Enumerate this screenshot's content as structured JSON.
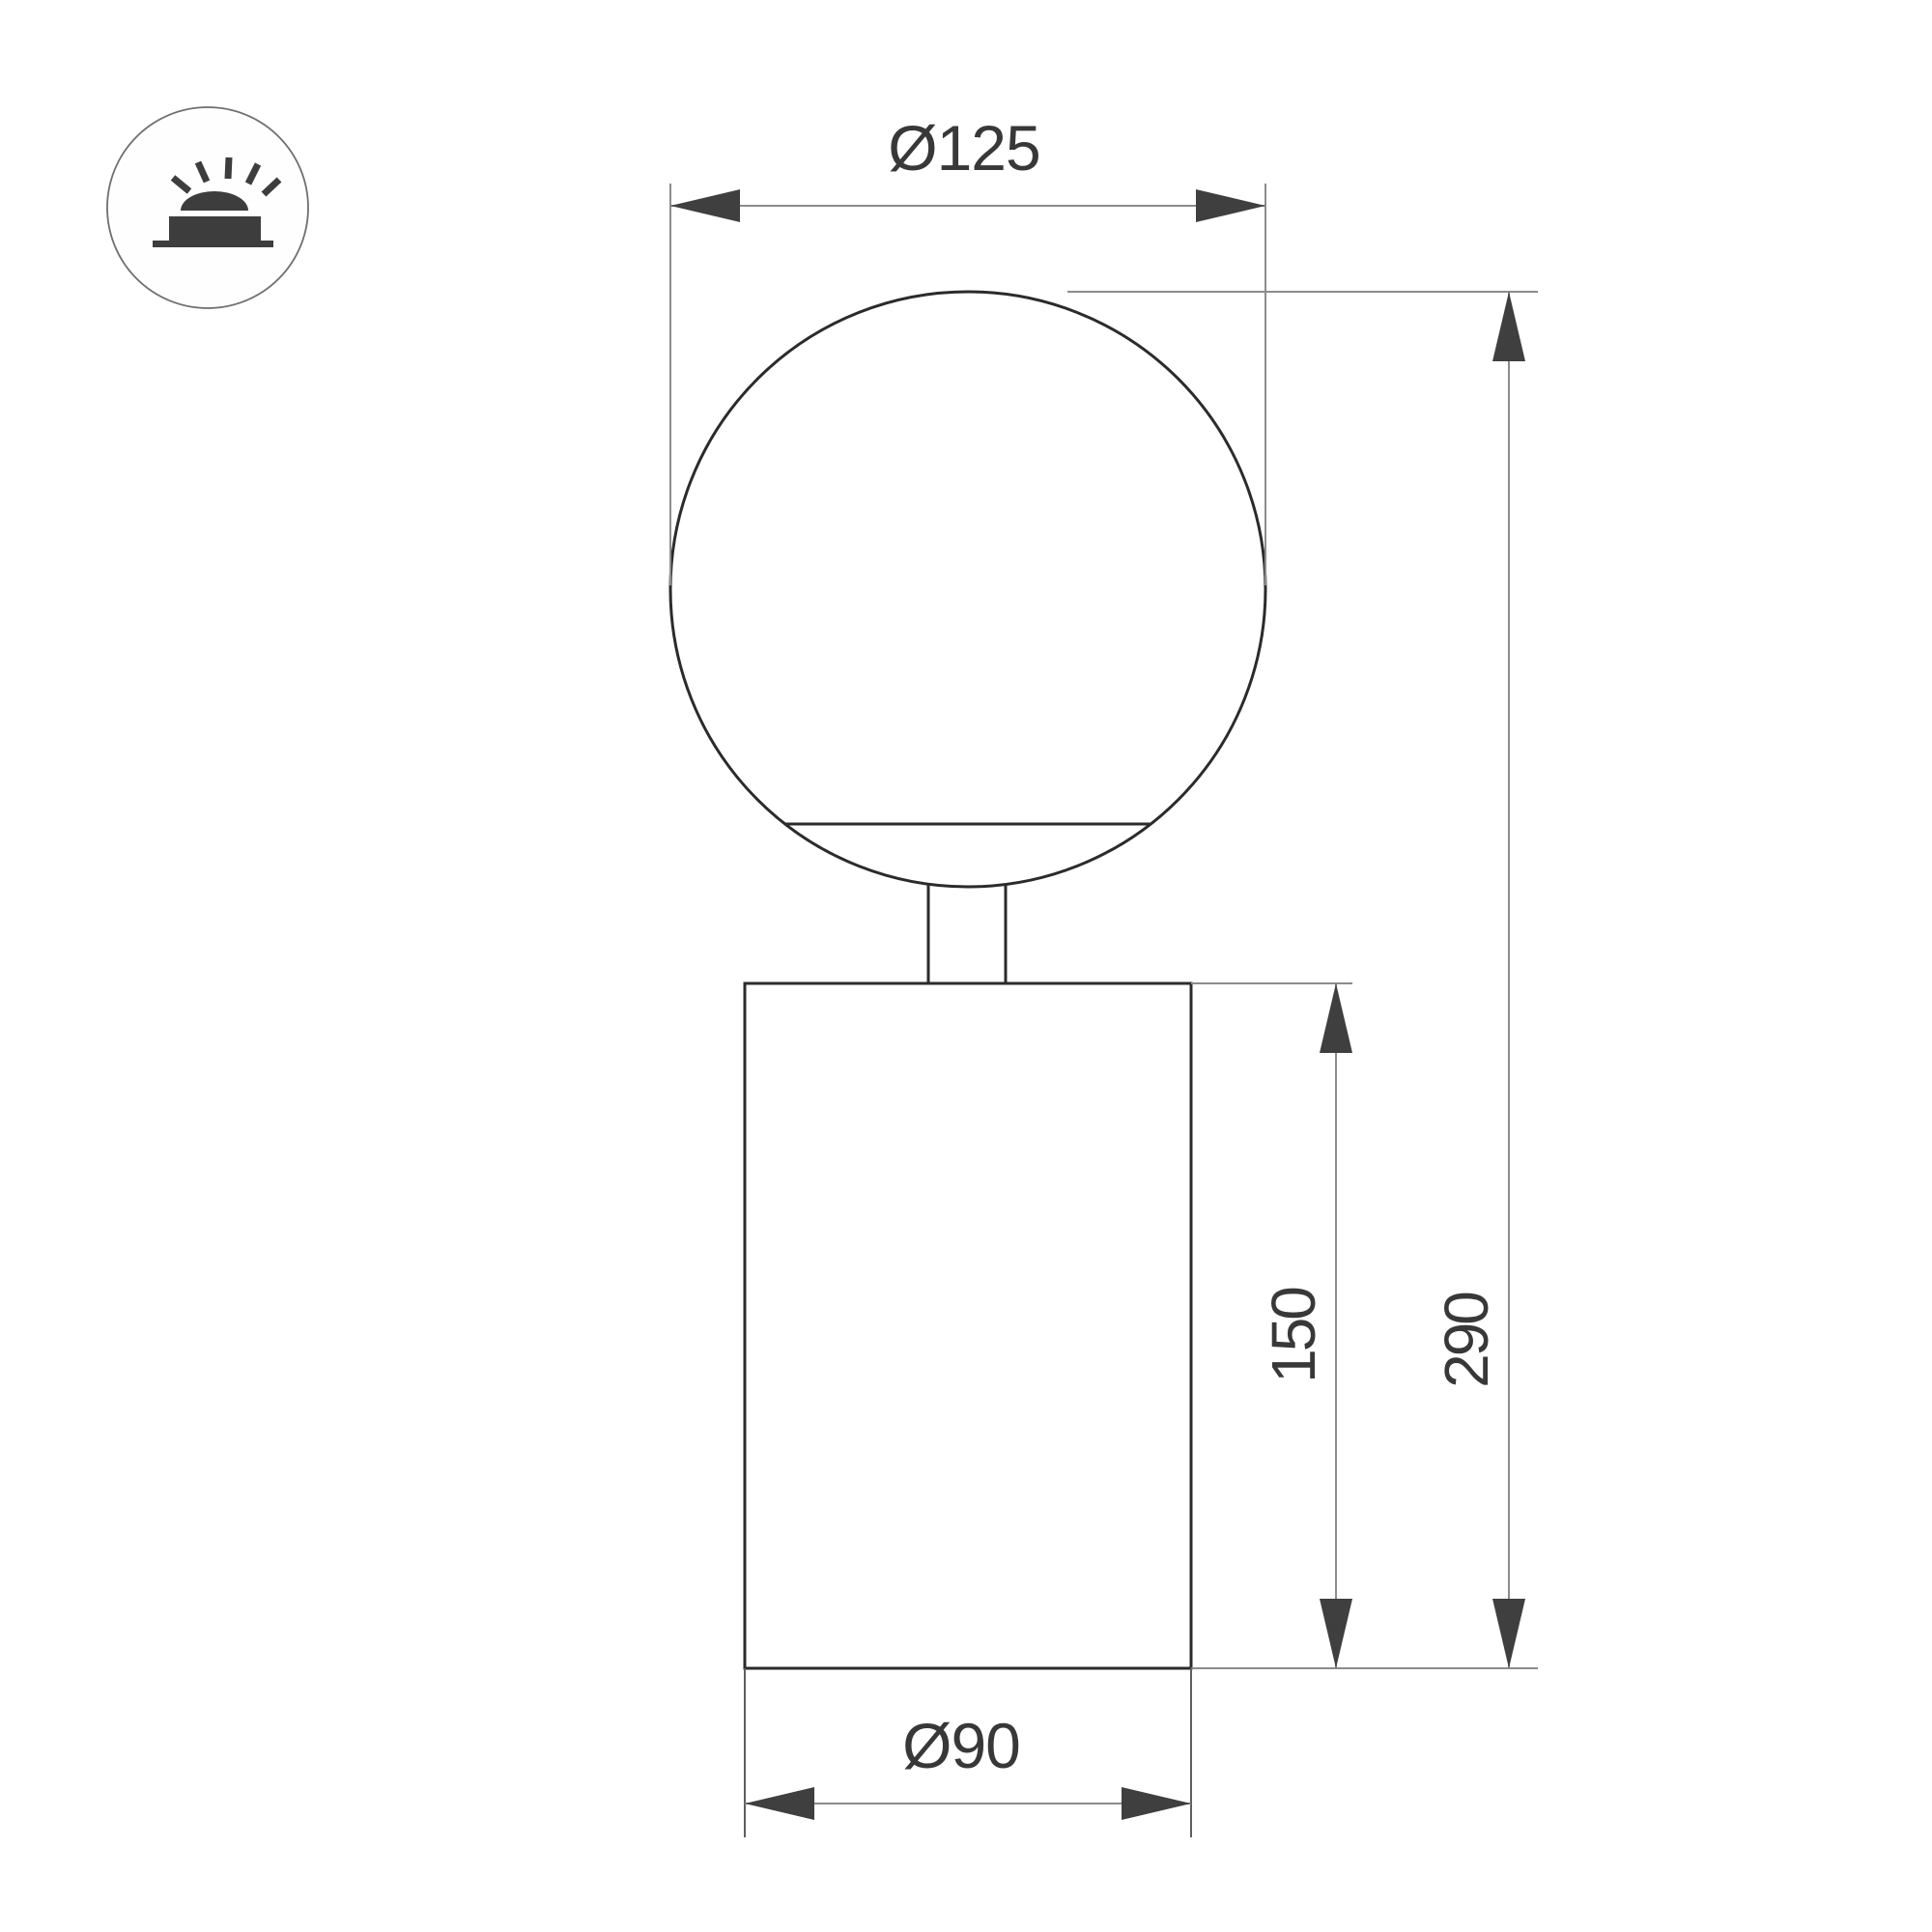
{
  "drawing": {
    "type": "technical-dimension-drawing",
    "background": "#ffffff",
    "labels": {
      "globe_diameter": "Ø125",
      "overall_height": "290",
      "body_height": "150",
      "body_diameter": "Ø90"
    },
    "values_mm": {
      "globe_diameter": 125,
      "overall_height": 290,
      "body_height": 150,
      "body_diameter": 90
    },
    "icon": {
      "name": "surface-mounted-light",
      "description": "dome light with rays above a mounting base, inside thin circle"
    },
    "colors": {
      "object_line": "#2b2b2b",
      "dimension_line": "#8c8c8c",
      "extension_line_dark": "#5f5f5f",
      "arrowhead": "#3f3f3f",
      "text": "#383838",
      "icon_glyph": "#3d3d3d",
      "icon_circle_stroke": "#6f6f6f",
      "background": "#ffffff"
    }
  }
}
